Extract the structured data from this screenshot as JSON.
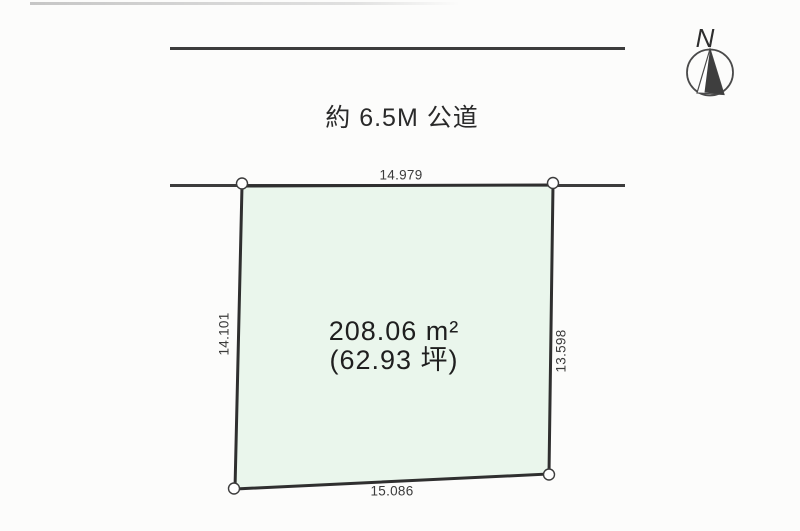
{
  "diagram": {
    "type": "land-plot-survey-diagram",
    "road": {
      "label": "約 6.5M 公道"
    },
    "compass": {
      "label": "N"
    },
    "parcel": {
      "fill_color": "#eaf6ec",
      "outline_color": "#2f2f2f",
      "area_m2": "208.06 m²",
      "area_tsubo": "(62.93 坪)",
      "dimensions": {
        "top": "14.979",
        "left": "14.101",
        "right": "13.598",
        "bottom": "15.086"
      }
    },
    "colors": {
      "road_line": "#3c3c3c",
      "text": "#2e2e2e",
      "background": "#fcfcfb"
    }
  }
}
